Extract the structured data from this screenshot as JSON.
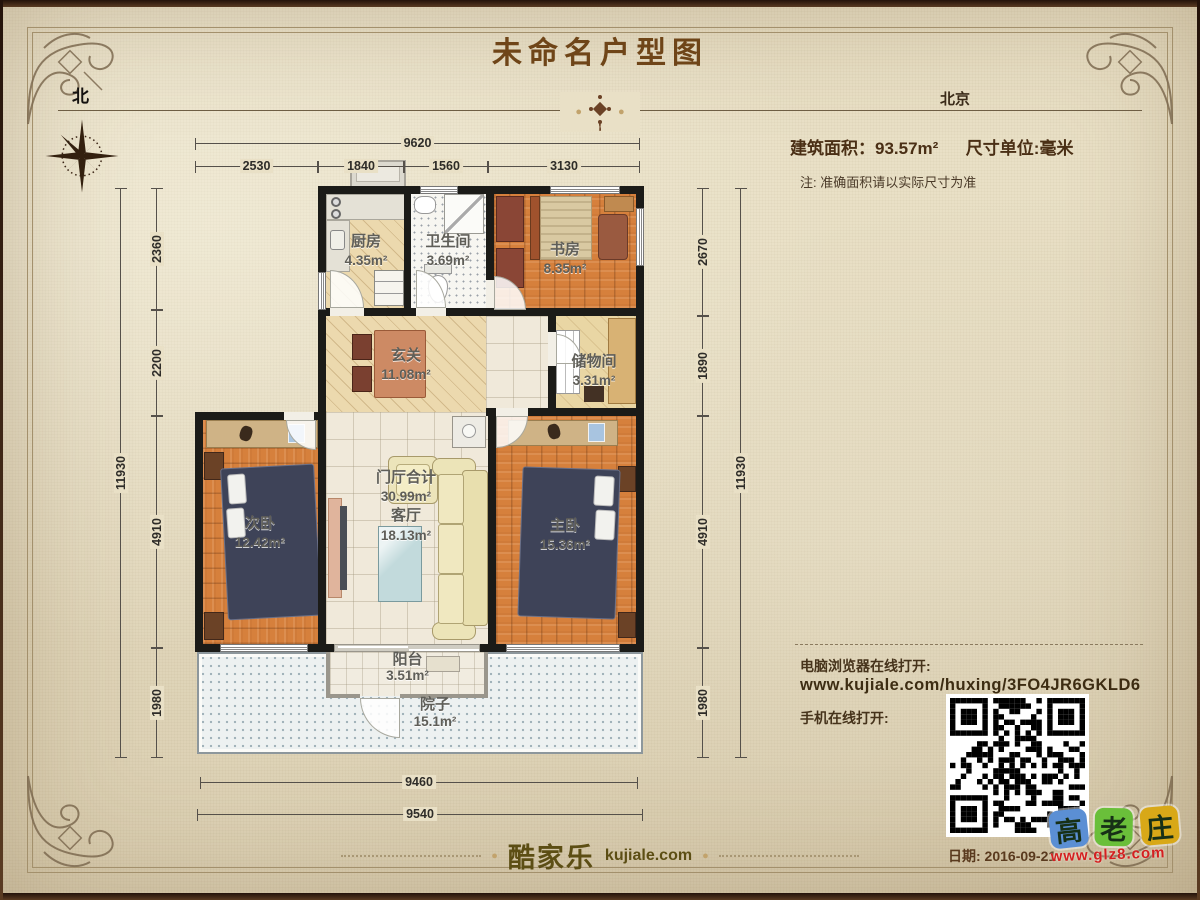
{
  "header": {
    "title": "未命名户型图",
    "north": "北",
    "city": "北京"
  },
  "info": {
    "area_label": "建筑面积：93.57m²",
    "unit_label": "尺寸单位:毫米",
    "note": "注: 准确面积请以实际尺寸为准"
  },
  "rooms": [
    {
      "name": "厨房",
      "area": "4.35m²"
    },
    {
      "name": "卫生间",
      "area": "3.69m²"
    },
    {
      "name": "书房",
      "area": "8.35m²"
    },
    {
      "name": "玄关",
      "area": "11.08m²"
    },
    {
      "name": "储物间",
      "area": "3.31m²"
    },
    {
      "name": "次卧",
      "area": "12.42m²"
    },
    {
      "name": "门厅合计",
      "area": "30.99m²"
    },
    {
      "name": "客厅",
      "area": "18.13m²"
    },
    {
      "name": "主卧",
      "area": "15.36m²"
    },
    {
      "name": "阳台",
      "area": "3.51m²"
    },
    {
      "name": "院子",
      "area": "15.1m²"
    }
  ],
  "dims": {
    "top_total": "9620",
    "top_segments": [
      "2530",
      "1840",
      "1560",
      "3130"
    ],
    "left_total": "11930",
    "left_segments": [
      "2360",
      "2200",
      "4910",
      "1980"
    ],
    "right_total": "11930",
    "right_segments": [
      "2670",
      "1890",
      "4910",
      "1980"
    ],
    "bottom_inner": "9460",
    "bottom_outer": "9540"
  },
  "links": {
    "pc_label": "电脑浏览器在线打开:",
    "url": "www.kujiale.com/huxing/3FO4JR6GKLD6",
    "mobile_label": "手机在线打开:"
  },
  "footer": {
    "logo_cn": "酷家乐",
    "logo_en": "kujiale.com",
    "date": "日期: 2016-09-21"
  },
  "watermark": {
    "char1": "高",
    "char2": "老",
    "char3": "庄",
    "url": "www.glz8.com"
  },
  "colors": {
    "wall": "#1b1b18",
    "wood_floor": "#d6803c",
    "bed": "#3e4358",
    "sofa": "#f0e8c0",
    "parchment": "#e9e0c6",
    "title_brown": "#6f4518",
    "qr_dark": "#000000",
    "watermark_red": "#d42020",
    "watermark_blue": "#5b8fd4",
    "watermark_green": "#6abf3a",
    "watermark_yellow": "#d8a818"
  }
}
